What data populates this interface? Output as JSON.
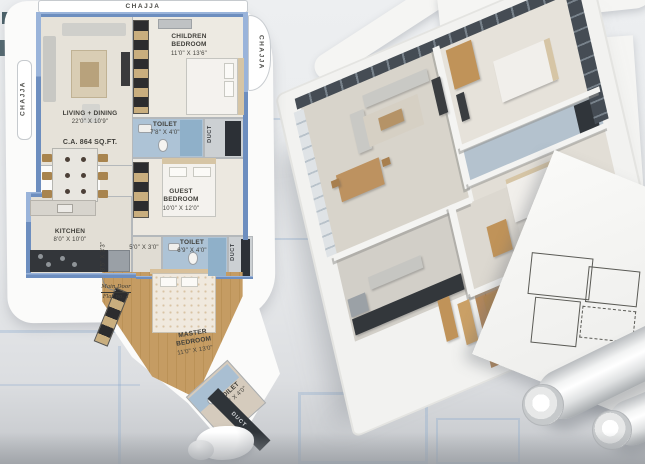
{
  "plan2d": {
    "chajja_top": "CHAJJA",
    "chajja_left": "CHAJJA",
    "chajja_right": "CHAJJA",
    "carpet_area": "C.A. 864 SQ.FT.",
    "duct": "DUCT",
    "main_door": {
      "line1": "Main Door",
      "line2": "Flat no. 1"
    },
    "rooms": {
      "living": {
        "name": "LIVING + DINING",
        "dims": "22'0\" X 10'9\""
      },
      "children": {
        "name": "CHILDREN BEDROOM",
        "dims": "11'0\" X 13'6\""
      },
      "toilet_top": {
        "name": "TOILET",
        "dims": "7'8\" X 4'0\""
      },
      "guest": {
        "name": "GUEST BEDROOM",
        "dims": "10'0\" X 12'0\""
      },
      "passage": {
        "dims": "5'0\" X 3'0\""
      },
      "passage_long": {
        "dims": "8'5\" X 3'3\""
      },
      "toilet_mid": {
        "name": "TOILET",
        "dims": "6'9\" X 4'0\""
      },
      "kitchen": {
        "name": "KITCHEN",
        "dims": "8'0\" X 10'0\""
      },
      "master": {
        "name": "MASTER BEDROOM",
        "dims": "11'0\" X 13'0\""
      },
      "toilet_bottom": {
        "name": "TOILET",
        "dims": "6'0\" X 4'0\""
      }
    }
  },
  "colors": {
    "outer_wall_blue": "#7191c2",
    "toilet_floor_blue": "#aac0d4",
    "wood_floor": "#c29a63",
    "duct_dark": "#2e3237",
    "glass_dark": "#454c54",
    "backdrop_white": "#fbfbfa",
    "background_gray": "#e9ebed"
  }
}
